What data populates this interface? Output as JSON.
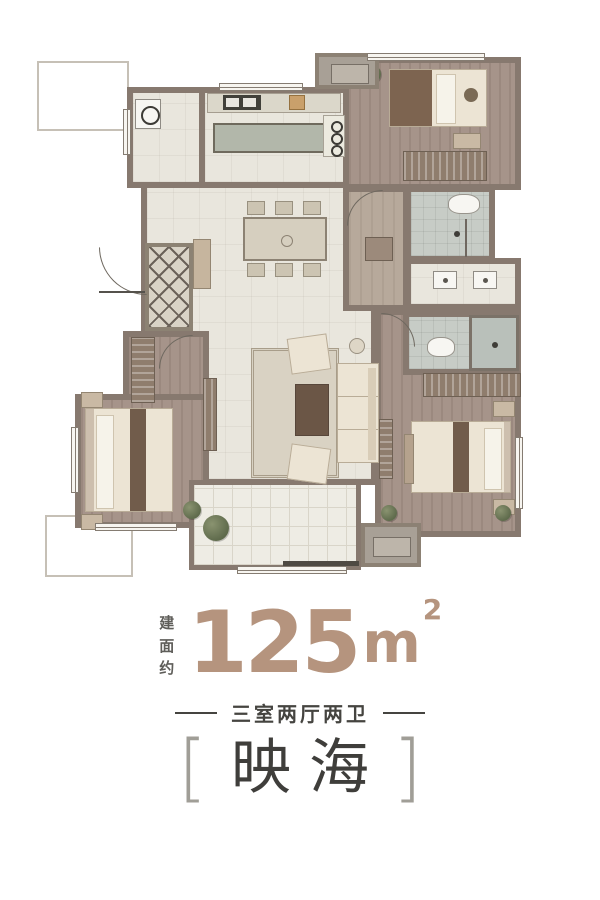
{
  "area": {
    "prefix": "建面约",
    "value": "125",
    "unit": "m",
    "sup": "2"
  },
  "subtitle": {
    "text": "三室两厅两卫"
  },
  "project": {
    "left_bracket": "[",
    "name": "映海",
    "right_bracket": "]"
  },
  "theme": {
    "accent": "#b5947e",
    "wall": "#87796f",
    "wood": "#a6948a",
    "tile": "#e9e6dd",
    "bath": "#c7ccc6",
    "cream": "#ece4d4",
    "rug": "#6b6259",
    "darktext": "#454440",
    "graytext": "#5f5e5a"
  },
  "floor_plan": {
    "type": "apartment-floor-plan",
    "rooms": [
      "laundry-room",
      "kitchen",
      "secondary-bedroom",
      "shared-bathroom",
      "vanity-area",
      "corridor",
      "dining-room",
      "entry-hall",
      "living-room",
      "small-bedroom",
      "master-bedroom",
      "master-bathroom",
      "balcony"
    ],
    "fixtures": [
      "washing-machine",
      "kitchen-sink",
      "kitchen-island",
      "stove",
      "double-bed-x3",
      "wardrobe-x3",
      "toilet-x2",
      "shower-x2",
      "double-vanity-sinks",
      "dining-table-6-chairs",
      "sofa",
      "coffee-table",
      "armchair-x2",
      "diamond-entry-rug",
      "balcony-plants"
    ]
  }
}
